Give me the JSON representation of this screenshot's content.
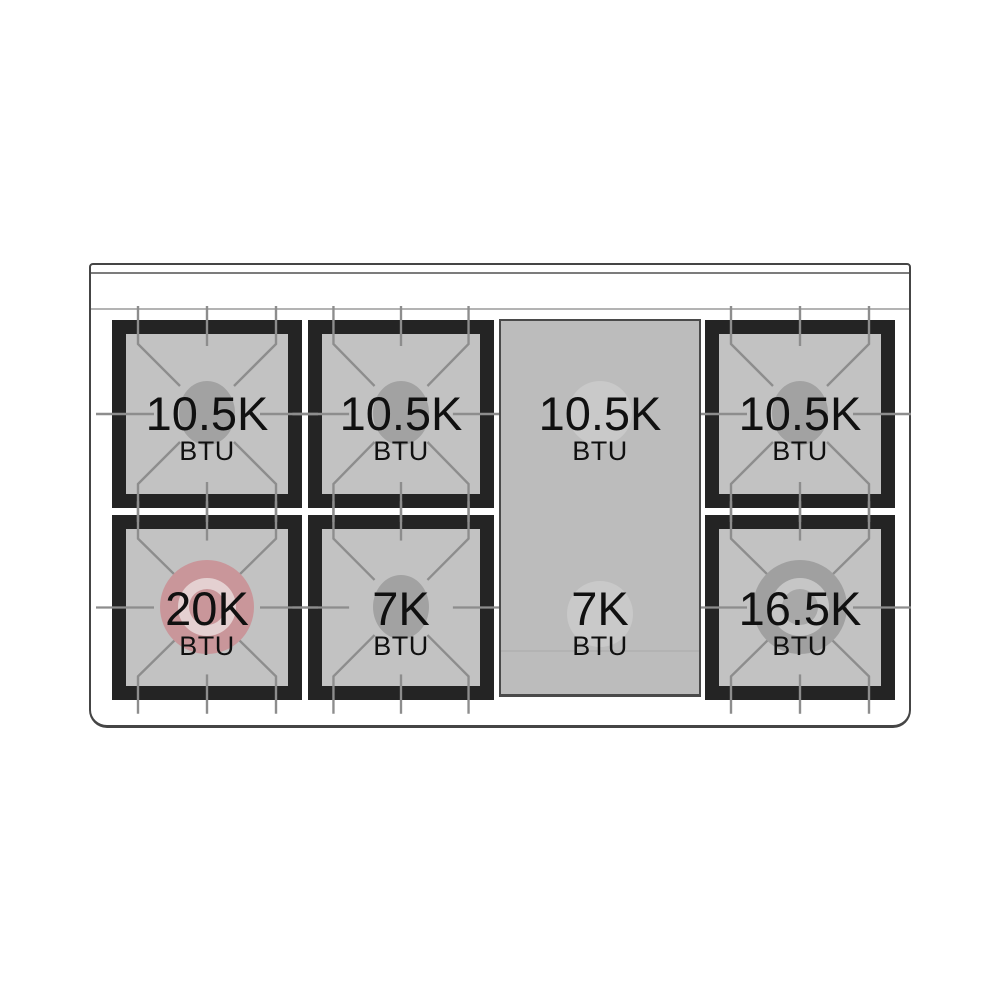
{
  "cooktop": {
    "description": "Gas range cooktop burner BTU diagram",
    "burners": [
      {
        "id": "top-left",
        "value": "10.5K",
        "unit": "BTU",
        "cap": "gray-oval"
      },
      {
        "id": "top-center-left",
        "value": "10.5K",
        "unit": "BTU",
        "cap": "gray-oval"
      },
      {
        "id": "griddle-top",
        "value": "10.5K",
        "unit": "BTU",
        "cap": "light-circle"
      },
      {
        "id": "top-right",
        "value": "10.5K",
        "unit": "BTU",
        "cap": "gray-oval"
      },
      {
        "id": "bottom-left",
        "value": "20K",
        "unit": "BTU",
        "cap": "pink-donut"
      },
      {
        "id": "bottom-center-left",
        "value": "7K",
        "unit": "BTU",
        "cap": "gray-oval"
      },
      {
        "id": "griddle-bottom",
        "value": "7K",
        "unit": "BTU",
        "cap": "light-circle"
      },
      {
        "id": "bottom-right",
        "value": "16.5K",
        "unit": "BTU",
        "cap": "gray-donut"
      }
    ],
    "colors": {
      "frame": "#242424",
      "surface": "#c2c2c2",
      "grate-line": "#8d8d8d",
      "cap-gray": "#a2a2a2",
      "griddle-bg": "#bcbcbc",
      "griddle-border": "#4a4a4a",
      "griddle-circle": "#c9c9c9",
      "pink": "#c9969a",
      "pink-ring": "#e4d0d1",
      "donut-gray": "#a0a0a0",
      "donut-gray-ring": "#c6c6c6",
      "donut-gray-core": "#a8a8a8",
      "body-border": "#454545",
      "trim": "#7c7c7c",
      "faint-line": "#b3b3b3",
      "text": "#101010"
    }
  }
}
